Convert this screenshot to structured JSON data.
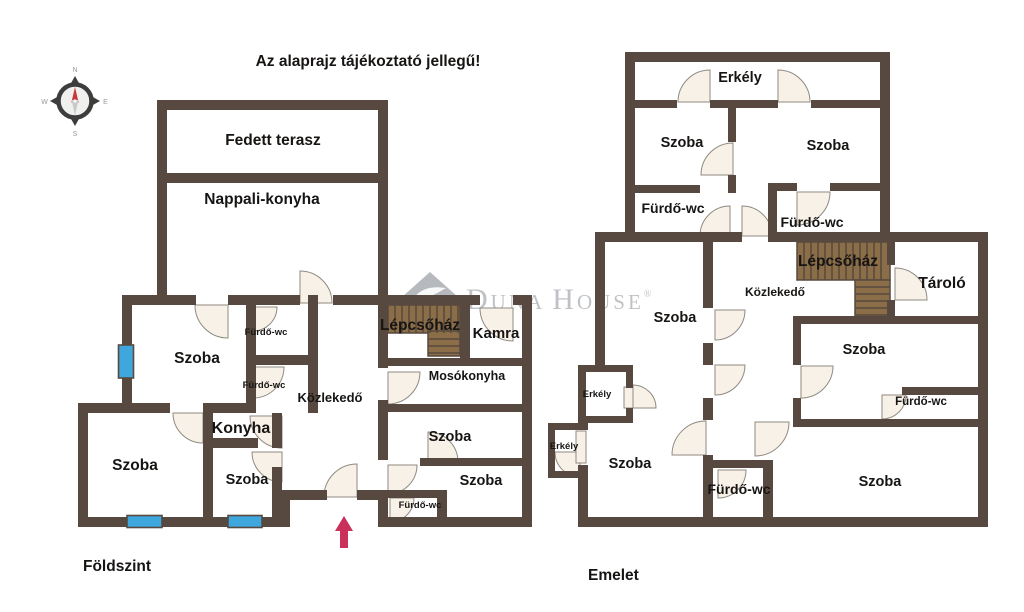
{
  "title": "Az alaprajz tájékoztató jellegű!",
  "compass": {
    "n": "N",
    "e": "E",
    "s": "S",
    "w": "W"
  },
  "watermark": {
    "part1": "D",
    "part2": "UNA ",
    "part3": "H",
    "part4": "OUSE",
    "reg": "®"
  },
  "colors": {
    "wall": "#57493f",
    "stairs": "#8b6e48",
    "door": "#f8f1e7",
    "window": "#3ea7dd",
    "arrow": "#c9305a",
    "watermark_gray": "#a7abb0"
  },
  "floors": {
    "ground": {
      "name": "Földszint",
      "rooms": [
        {
          "label": "Fedett terasz"
        },
        {
          "label": "Nappali-konyha"
        },
        {
          "label": "Szoba"
        },
        {
          "label": "Fürdő-wc"
        },
        {
          "label": "Fürdő-wc"
        },
        {
          "label": "Konyha"
        },
        {
          "label": "Közlekedő"
        },
        {
          "label": "Szoba"
        },
        {
          "label": "Szoba"
        },
        {
          "label": "Lépcsőház"
        },
        {
          "label": "Kamra"
        },
        {
          "label": "Mosókonyha"
        },
        {
          "label": "Szoba"
        },
        {
          "label": "Szoba"
        },
        {
          "label": "Fürdő-wc"
        }
      ]
    },
    "upper": {
      "name": "Emelet",
      "rooms": [
        {
          "label": "Erkély"
        },
        {
          "label": "Szoba"
        },
        {
          "label": "Szoba"
        },
        {
          "label": "Fürdő-wc"
        },
        {
          "label": "Fürdő-wc"
        },
        {
          "label": "Lépcsőház"
        },
        {
          "label": "Közlekedő"
        },
        {
          "label": "Tároló"
        },
        {
          "label": "Szoba"
        },
        {
          "label": "Szoba"
        },
        {
          "label": "Fürdő-wc"
        },
        {
          "label": "Erkély"
        },
        {
          "label": "Erkély"
        },
        {
          "label": "Szoba"
        },
        {
          "label": "Fürdő-wc"
        },
        {
          "label": "Szoba"
        }
      ]
    }
  }
}
